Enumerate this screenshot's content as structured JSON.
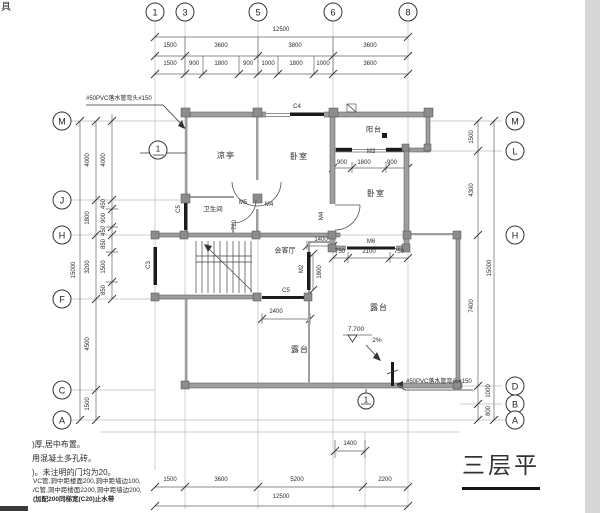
{
  "corner_glyph": "具",
  "axes": {
    "top": [
      "1",
      "3",
      "5",
      "6",
      "8"
    ],
    "left": [
      "M",
      "J",
      "H",
      "F",
      "C",
      "A"
    ],
    "right": [
      "M",
      "L",
      "H",
      "D",
      "B",
      "A"
    ]
  },
  "dims": {
    "top_total": "12500",
    "top_row2": [
      "1500",
      "3600",
      "3800",
      "3600"
    ],
    "top_row3": [
      "1500",
      "900",
      "1800",
      "900",
      "1000",
      "1800",
      "1000",
      "3600"
    ],
    "left_total": "15000",
    "left_col1": [
      "4000",
      "1800",
      "3200",
      "4500",
      "1500"
    ],
    "left_col2": [
      "4000",
      "450",
      "900",
      "450",
      "850",
      "1500",
      "850"
    ],
    "right_col": [
      "1500",
      "4300",
      "7400",
      "1000",
      "800"
    ],
    "right_total": "15000",
    "bottom_1400": "1400",
    "bottom_row": [
      "1500",
      "3600",
      "5200",
      "2200"
    ],
    "bottom_total": "12500",
    "m3": [
      "900",
      "1800",
      "900"
    ],
    "m6": [
      "750",
      "2100",
      "750"
    ],
    "mid_1400": "1400",
    "vert_1800": "1800",
    "dim_2400": "2400",
    "dim_720": "720"
  },
  "rooms": {
    "pavilion": "凉亭",
    "bedroom_top": "卧室",
    "balcony": "阳台",
    "bedroom_right": "卧室",
    "bathroom": "卫生间",
    "living": "会客厅",
    "terrace_bottom": "露台",
    "terrace_right": "露台"
  },
  "openings": {
    "c3": "C3",
    "c4": "C4",
    "c5_left": "C5",
    "c5_mid": "C5",
    "m2": "M2",
    "m3": "M3",
    "m4_a": "M4",
    "m4_b": "M4",
    "m5": "M5",
    "m6": "M6"
  },
  "annotations": {
    "pvc_top": "#50PVC落水管弯头#150",
    "pvc_bottom": "#50PVC落水管弯头#150",
    "elevation": "7.700",
    "slope": "2%",
    "section_left": "1",
    "section_bottom": "1"
  },
  "notes": [
    ")厚,居中布置。",
    "用混凝土多孔砖。",
    ")。未注明的门均为20。",
    "VC管,洞中距楼面200,洞中距墙边100,",
    "/C管,洞中距楼面2200,洞中距墙边200,",
    "(加配200同梯宽(C20)止水带"
  ],
  "title": "三层平"
}
